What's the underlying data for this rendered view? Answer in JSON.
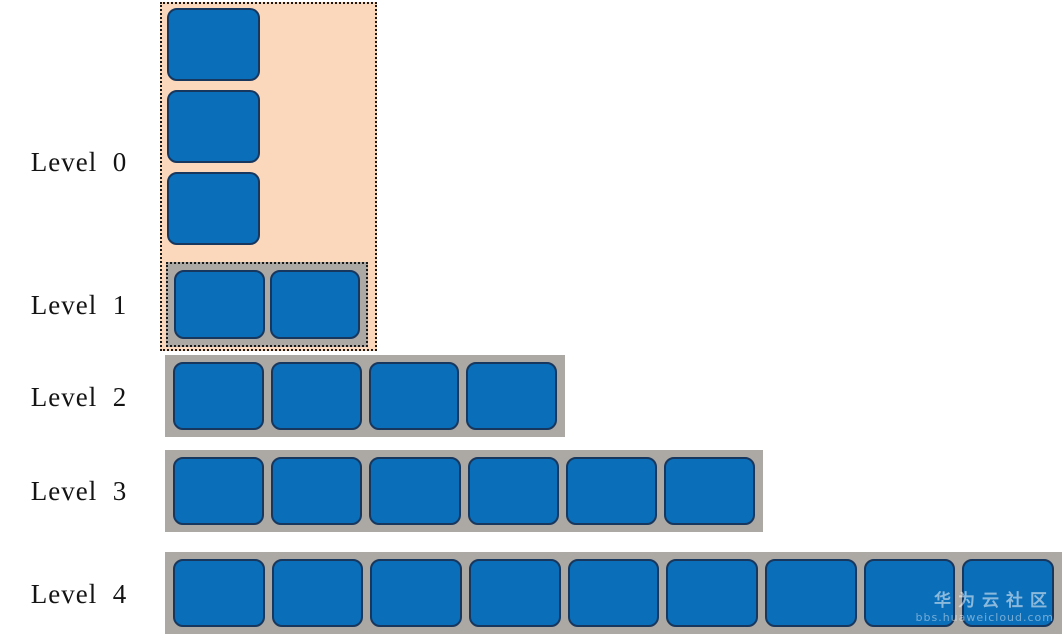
{
  "levels": [
    {
      "label": "Level  0",
      "block_count": 3,
      "layout": "vertical-stack"
    },
    {
      "label": "Level  1",
      "block_count": 2,
      "layout": "horizontal-row"
    },
    {
      "label": "Level  2",
      "block_count": 4,
      "layout": "horizontal-row"
    },
    {
      "label": "Level  3",
      "block_count": 6,
      "layout": "horizontal-row"
    },
    {
      "label": "Level  4",
      "block_count": 9,
      "layout": "horizontal-row"
    }
  ],
  "watermark": {
    "line1": "华为云社区",
    "line2": "bbs.huaweicloud.com"
  },
  "colors": {
    "block_fill": "#0A6EB9",
    "block_border": "#17375E",
    "group_fill": "#FBD8BB",
    "row_fill": "#ACA8A3",
    "dotted_border": "#1A1A1A"
  }
}
